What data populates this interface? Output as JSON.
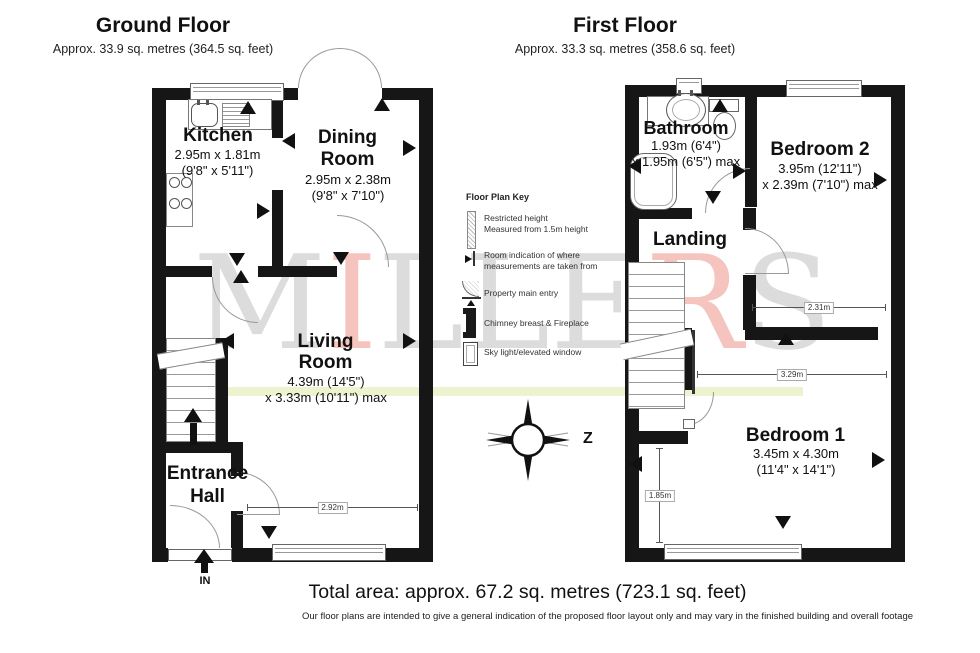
{
  "ground_floor": {
    "title": "Ground Floor",
    "subtitle": "Approx. 33.9 sq. metres (364.5 sq. feet)",
    "kitchen": {
      "name": "Kitchen",
      "dim1": "2.95m x 1.81m",
      "dim2": "(9'8\" x 5'11\")"
    },
    "dining": {
      "name1": "Dining",
      "name2": "Room",
      "dim1": "2.95m x 2.38m",
      "dim2": "(9'8\" x 7'10\")"
    },
    "living": {
      "name1": "Living",
      "name2": "Room",
      "dim1": "4.39m (14'5\")",
      "dim2": "x 3.33m (10'11\") max"
    },
    "entrance": {
      "name1": "Entrance",
      "name2": "Hall"
    },
    "in_label": "IN",
    "dim_living_width": "2.92m"
  },
  "first_floor": {
    "title": "First Floor",
    "subtitle": "Approx. 33.3 sq. metres (358.6 sq. feet)",
    "bathroom": {
      "name": "Bathroom",
      "dim1": "1.93m (6'4\")",
      "dim2": "x 1.95m (6'5\") max"
    },
    "bedroom2": {
      "name": "Bedroom 2",
      "dim1": "3.95m (12'11\")",
      "dim2": "x 2.39m (7'10\") max"
    },
    "landing": {
      "name": "Landing"
    },
    "bedroom1": {
      "name": "Bedroom 1",
      "dim1": "3.45m x 4.30m",
      "dim2": "(11'4\" x 14'1\")"
    },
    "dim_bedroom2_width": "2.31m",
    "dim_bedroom1_width": "3.29m",
    "dim_landing_depth": "1.85m"
  },
  "key": {
    "title": "Floor Plan Key",
    "items": [
      {
        "icon": "restricted-height-icon",
        "line1": "Restricted height",
        "line2": "Measured from 1.5m height"
      },
      {
        "icon": "measurement-point-icon",
        "line1": "Room indication of where",
        "line2": "measurements are taken from"
      },
      {
        "icon": "property-entry-icon",
        "line1": "Property main entry",
        "line2": ""
      },
      {
        "icon": "chimney-fireplace-icon",
        "line1": "Chimney breast & Fireplace",
        "line2": ""
      },
      {
        "icon": "skylight-window-icon",
        "line1": "Sky light/elevated window",
        "line2": ""
      }
    ]
  },
  "compass": {
    "north_label": "Z"
  },
  "watermark": {
    "text": "MILLERS",
    "letters": [
      {
        "ch": "M",
        "color": "#dcdcdc"
      },
      {
        "ch": "I",
        "color": "#f5c4be"
      },
      {
        "ch": "L",
        "color": "#dcdcdc"
      },
      {
        "ch": "L",
        "color": "#dcdcdc"
      },
      {
        "ch": "E",
        "color": "#dcdcdc"
      },
      {
        "ch": "R",
        "color": "#f5c4be"
      },
      {
        "ch": "S",
        "color": "#dcdcdc"
      }
    ]
  },
  "footer": {
    "total_area": "Total area: approx. 67.2 sq. metres (723.1 sq. feet)",
    "disclaimer": "Our floor plans are intended to give a general indication of the proposed floor layout only and may vary in the finished building and overall footage"
  },
  "colors": {
    "wall": "#161616",
    "accent_band": "#edf2cf",
    "watermark_gray": "#dcdcdc",
    "watermark_pink": "#f5c4be"
  }
}
